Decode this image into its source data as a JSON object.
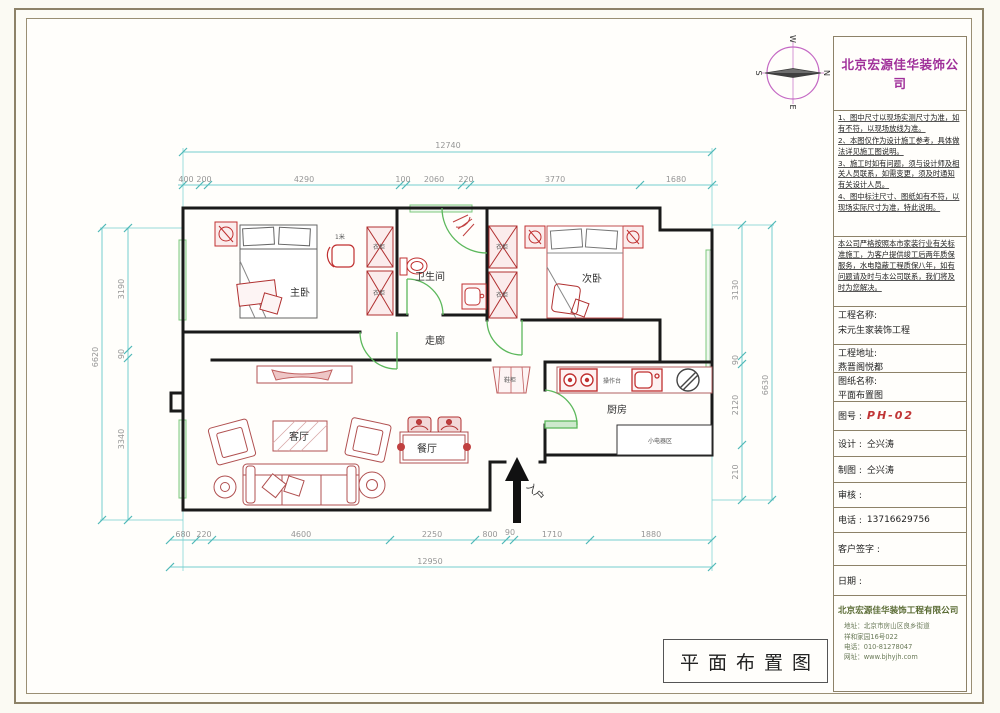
{
  "sheet": {
    "bottom_title": "平面布置图"
  },
  "compass": {
    "top": "W",
    "right": "N",
    "bottom": "E",
    "left": "S"
  },
  "title_block": {
    "company_name": "北京宏源佳华装饰公司",
    "notes": [
      "1、图中尺寸以现场实测尺寸为准，如有不符，以现场放线为准。",
      "2、本图仅作为设计施工参考，具体做法详见施工图说明。",
      "3、施工时如有问题，须与设计师及相关人员联系，如需变更，须及时通知有关设计人员。",
      "4、图中标注尺寸、图纸如有不符，以现场实际尺寸为准，特此说明。"
    ],
    "service_note": "本公司严格按照本市家装行业有关标准施工，为客户提供竣工后两年质保服务，水电隐蔽工程质保八年，如有问题请及时与本公司联系，我们将及时为您解决。",
    "project_name_label": "工程名称:",
    "project_name": "宋元生家装饰工程",
    "address_label": "工程地址:",
    "address": "燕晋阁悦都",
    "drawing_name_label": "图纸名称:",
    "drawing_name": "平面布置图",
    "drawing_no_label": "图号 :",
    "drawing_no": "PH-02",
    "designer_label": "设计 :",
    "designer": "仝兴涛",
    "drafter_label": "制图 :",
    "drafter": "仝兴涛",
    "reviewer_label": "审核 :",
    "reviewer": "",
    "phone_label": "电话 :",
    "phone": "13716629756",
    "signature_label": "客户签字 :",
    "date_label": "日期 :",
    "footer_company": "北京宏源佳华装饰工程有限公司",
    "footer_lines": [
      "地址：北京市房山区良乡街道",
      "祥和家园16号022",
      "电话：010-81278047",
      "网址：www.bjhyjh.com"
    ]
  },
  "plan": {
    "rooms": {
      "master": "主卧",
      "second": "次卧",
      "bathroom": "卫生间",
      "corridor": "走廊",
      "living": "客厅",
      "dining": "餐厅",
      "kitchen": "厨房",
      "entry": "入户"
    },
    "labels": {
      "wardrobe": "衣柜",
      "shoe_cabinet": "鞋柜",
      "counter": "操作台",
      "appliance_area": "小电器区",
      "chair": "1米"
    },
    "dims": {
      "top_total": "12740",
      "top": [
        "400",
        "200",
        "4290",
        "100",
        "2060",
        "220",
        "3770",
        "1680"
      ],
      "bottom": [
        "680",
        "220",
        "4600",
        "2250",
        "800",
        "90",
        "1710",
        "1880"
      ],
      "bottom_total": "12950",
      "left": [
        "3190",
        "90",
        "3340"
      ],
      "left_total": "6620",
      "right": [
        "3130",
        "90",
        "2120",
        "210"
      ],
      "right_total": "6630"
    }
  }
}
